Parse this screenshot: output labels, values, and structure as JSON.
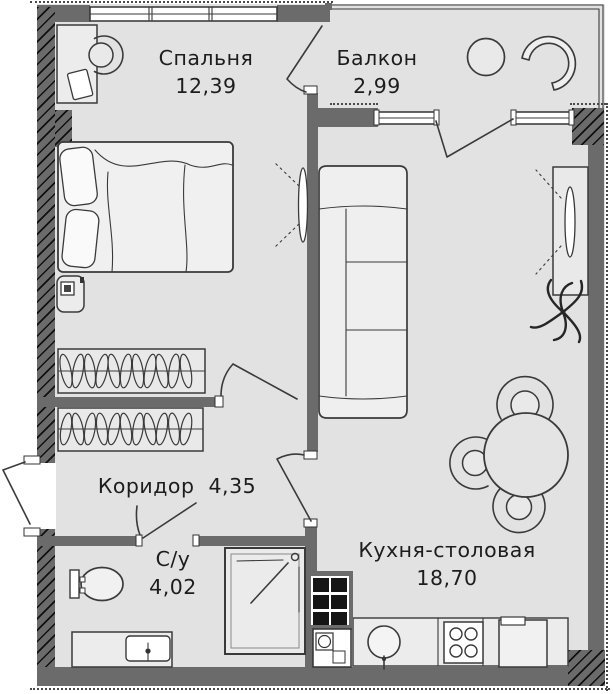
{
  "rooms": {
    "bedroom": {
      "label": "Спальня",
      "area": "12,39"
    },
    "balcony": {
      "label": "Балкон",
      "area": "2,99"
    },
    "corridor": {
      "label": "Коридор",
      "area": "4,35"
    },
    "bathroom": {
      "label": "С/у",
      "area": "4,02"
    },
    "kitchen": {
      "label": "Кухня-столовая",
      "area": "18,70"
    }
  },
  "colors": {
    "floor": "#e2e2e2",
    "wall": "#6b6b6b",
    "outline": "#3a3a3a",
    "hatch": "#1c1c1c",
    "text": "#1d1d1d"
  }
}
